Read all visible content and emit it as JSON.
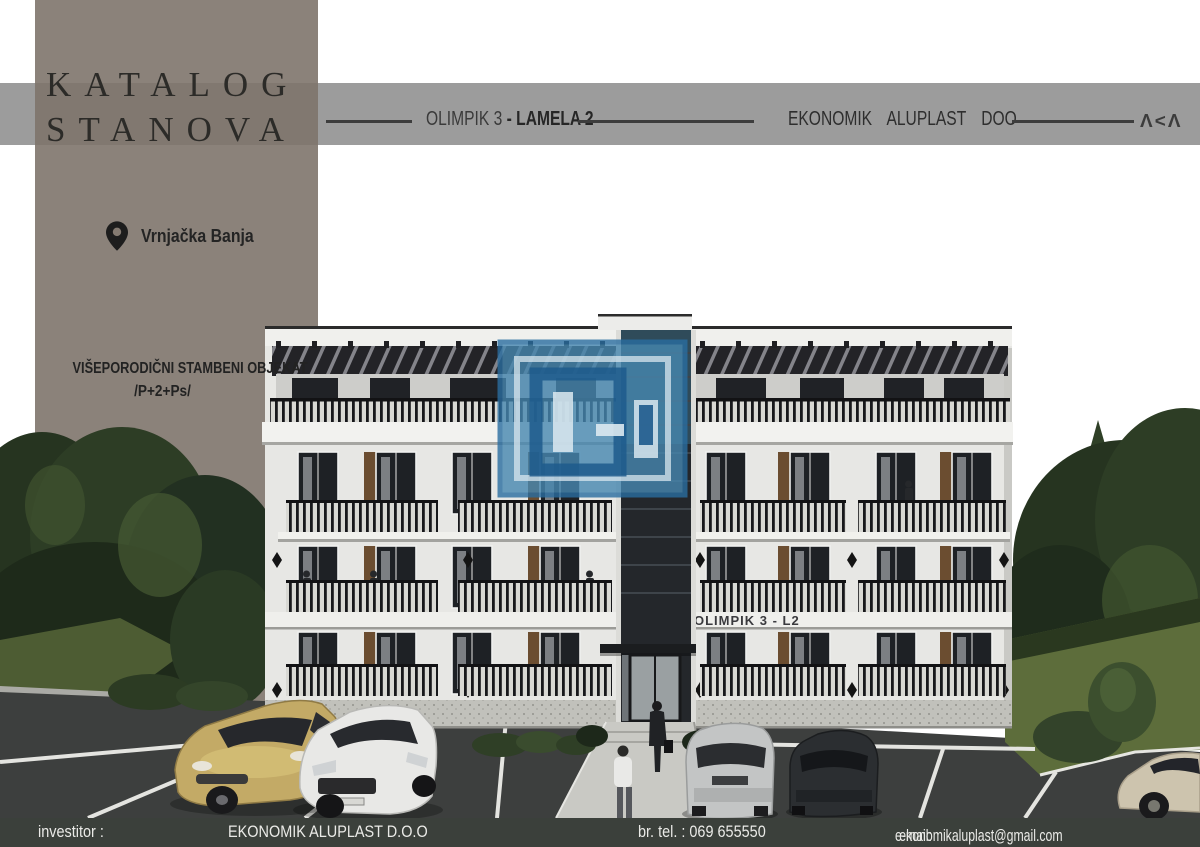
{
  "banner": {
    "title_line1": "KATALOG",
    "title_line2": "STANOVA",
    "location": "Vrnjačka Banja",
    "building_type": "VIŠEPORODIČNI STAMBENI OBJEKAT",
    "floors": "/P+2+Ps/",
    "panel_color": "#8a8078"
  },
  "header": {
    "project": "OLIMPIK 3",
    "dash": "-",
    "section": "LAMELA 2",
    "company": "EKONOMIK ALUPLAST DOO",
    "logo_mark": "Λ<Λ",
    "band_color": "#9c9c9c"
  },
  "building": {
    "sign": "OLIMPIK 3 - L2"
  },
  "watermark": {
    "color": "#3b7fae"
  },
  "footer": {
    "investor_label": "investitor :",
    "investor_name": "EKONOMIK ALUPLAST D.O.O",
    "phone": "br. tel. : 069 655550",
    "email_label": "e-mail:",
    "email": "ekonomikaluplast@gmail.com",
    "bg_color": "#3b403b"
  }
}
